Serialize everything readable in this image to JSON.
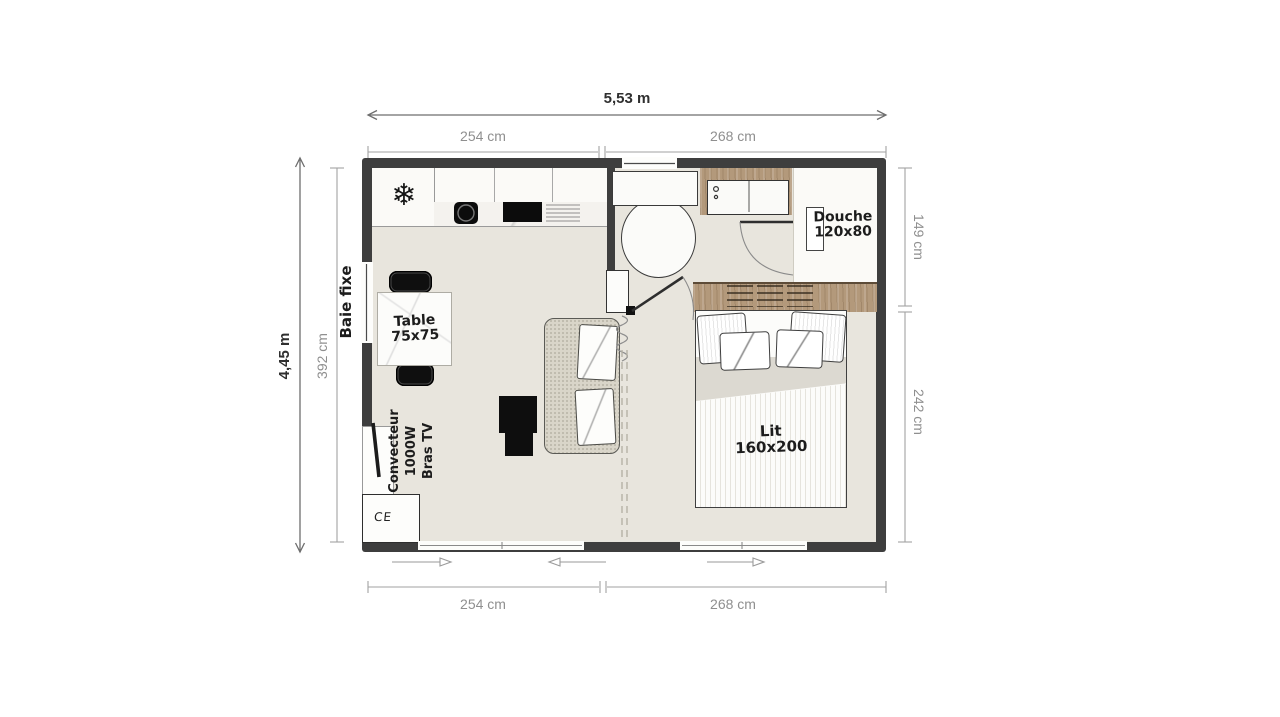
{
  "dimensions": {
    "width_total": "5,53 m",
    "width_left_top": "254 cm",
    "width_right_top": "268 cm",
    "width_left_bottom": "254 cm",
    "width_right_bottom": "268 cm",
    "height_total": "4,45 m",
    "height_inner": "392 cm",
    "depth_bathroom": "149 cm",
    "depth_bedroom": "242 cm"
  },
  "labels": {
    "fixed_window": "Baie fixe",
    "table": [
      "Table",
      "75x75"
    ],
    "heater": [
      "Convecteur",
      "1000W",
      "Bras TV"
    ],
    "shower": [
      "Douche",
      "120x80"
    ],
    "bed": [
      "Lit",
      "160x200"
    ],
    "ce_mark": "CE"
  },
  "icons": {
    "freezer_snowflake": "❄"
  },
  "colors": {
    "wall": "#3e3e3e",
    "floor": "#e8e5dd",
    "wood": "#b3997b",
    "dim_primary": "#2f2f2f",
    "dim_secondary": "#8f8f8f"
  }
}
